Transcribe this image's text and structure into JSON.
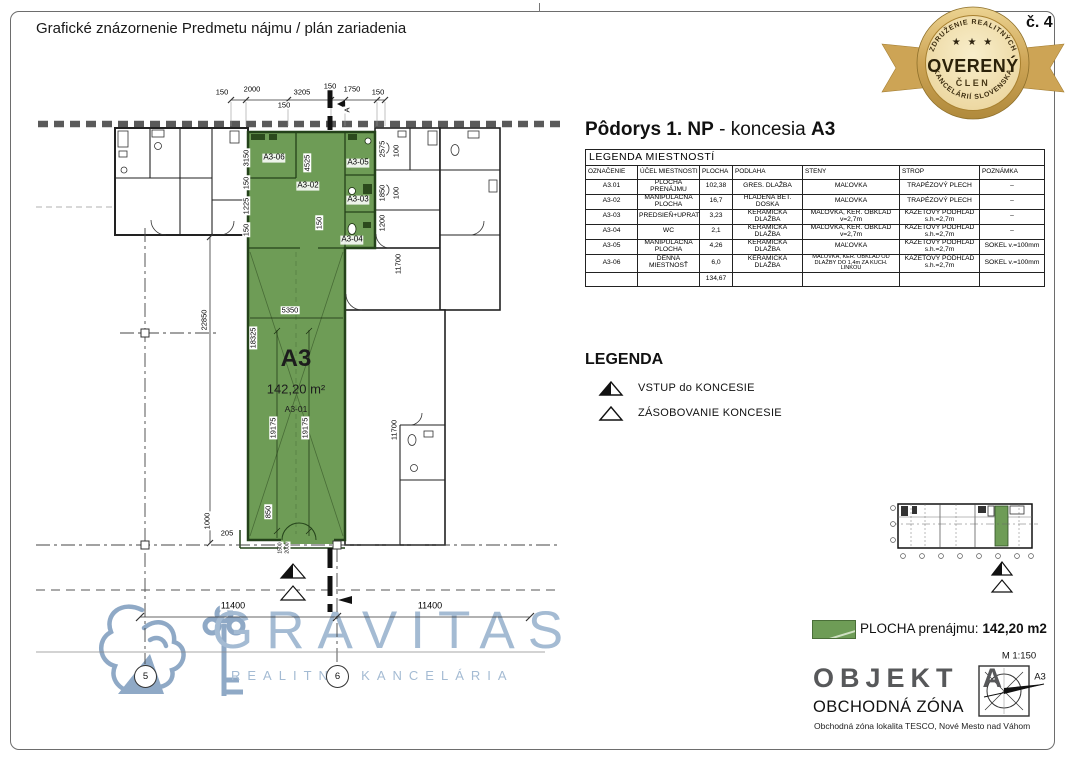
{
  "page": {
    "title": "Grafické znázornenie Predmetu nájmu / plán zariadenia",
    "page_number": "č. 4"
  },
  "badge": {
    "arc_top": "ZDRUŽENIE REALITNÝCH",
    "arc_bottom": "KANCELÁRIÍ SLOVENSKA",
    "stars": "★ ★ ★",
    "title": "OVERENÝ",
    "subtitle": "ČLEN"
  },
  "heading": {
    "bold1": "Pôdorys 1. NP",
    "mid": " - koncesia ",
    "bold2": "A3"
  },
  "room_table": {
    "title": "LEGENDA MIESTNOSTÍ",
    "columns": [
      "OZNAČENIE",
      "ÚČEL MIESTNOSTI",
      "PLOCHA",
      "PODLAHA",
      "STENY",
      "STROP",
      "POZNÁMKA"
    ],
    "rows": [
      [
        "A3.01",
        "PLOCHA PRENÁJMU",
        "102,38",
        "GRES. DLAŽBA",
        "MAĽOVKA",
        "TRAPÉZOVÝ PLECH",
        "–"
      ],
      [
        "A3-02",
        "MANIPULAČNÁ PLOCHA",
        "16,7",
        "HLADENÁ BET. DOSKA",
        "MAĽOVKA",
        "TRAPÉZOVÝ PLECH",
        "–"
      ],
      [
        "A3-03",
        "PREDSIEŇ+UPRATOVAČKA",
        "3,23",
        "KERAMICKÁ DLAŽBA",
        "MAĽOVKA, KER. OBKLAD v=2,7m",
        "KAZETOVÝ PODHĽAD s.h.=2,7m",
        "–"
      ],
      [
        "A3-04",
        "WC",
        "2,1",
        "KERAMICKÁ DLAŽBA",
        "MAĽOVKA, KER. OBKLAD v=2,7m",
        "KAZETOVÝ PODHĽAD s.h.=2,7m",
        "–"
      ],
      [
        "A3-05",
        "MANIPULAČNÁ PLOCHA",
        "4,26",
        "KERAMICKÁ DLAŽBA",
        "MAĽOVKA",
        "KAZETOVÝ PODHĽAD s.h.=2,7m",
        "SOKEL v.=100mm"
      ],
      [
        "A3-06",
        "DENNÁ MIESTNOSŤ",
        "6,0",
        "KERAMICKÁ DLAŽBA",
        "MAĽOVKA, KER. OBKLAD OD DLAŽBY DO 1,4m ZA KUCH. LINKOU",
        "KAZETOVÝ PODHĽAD s.h.=2,7m",
        "SOKEL v.=100mm"
      ]
    ],
    "total": "134,67"
  },
  "legend": {
    "title": "LEGENDA",
    "items": [
      {
        "icon": "triangle-half-filled",
        "label": "VSTUP do KONCESIE"
      },
      {
        "icon": "triangle-outline",
        "label": "ZÁSOBOVANIE KONCESIE"
      }
    ]
  },
  "summary": {
    "label": "PLOCHA prenájmu:",
    "value": "142,20 m2"
  },
  "object_block": {
    "name": "OBJEKT",
    "variant": "A",
    "scale": "M 1:150",
    "sheet": "A3",
    "zone": "OBCHODNÁ ZÓNA",
    "location": "Obchodná zóna lokalita TESCO, Nové Mesto nad Váhom"
  },
  "watermark": {
    "wordmark": "GRAVITAS",
    "tagline": "REALITNÁ KANCELÁRIA"
  },
  "plan": {
    "unit": {
      "label": "A3",
      "area": "142,20 m²",
      "room": "A3-01"
    },
    "rooms": {
      "a302": "A3-02",
      "a303": "A3-03",
      "a304": "A3-04",
      "a305": "A3-05",
      "a306": "A3-06"
    },
    "grid": {
      "g5": "5",
      "g6": "6"
    },
    "dims": {
      "t150a": "150",
      "t2000": "2000",
      "t3205": "3205",
      "t150sub": "150",
      "t150b": "150",
      "t1750": "1750",
      "t150c": "150",
      "section": "A",
      "v3150": "3150",
      "v150a": "150",
      "v1225": "1225",
      "v150b": "150",
      "v4525": "4525",
      "v150c": "150",
      "v2575": "2575",
      "v100a": "100",
      "v1850": "1850",
      "v100b": "100",
      "v1200": "1200",
      "v11700a": "11700",
      "v11700b": "11700",
      "v22850": "22850",
      "v18325": "18325",
      "v19175a": "19175",
      "v19175b": "19175",
      "h5350": "5350",
      "v850": "850",
      "v1000": "1000",
      "h205": "205",
      "e1500": "1500",
      "e2000": "2000",
      "h11400a": "11400",
      "h11400b": "11400"
    }
  },
  "colors": {
    "lease_green": "#6e9c56",
    "wall_green": "#24421a",
    "badge_gold": "#cda455",
    "watermark_blue": "#a4bbd3",
    "object_gray": "#57585a"
  }
}
